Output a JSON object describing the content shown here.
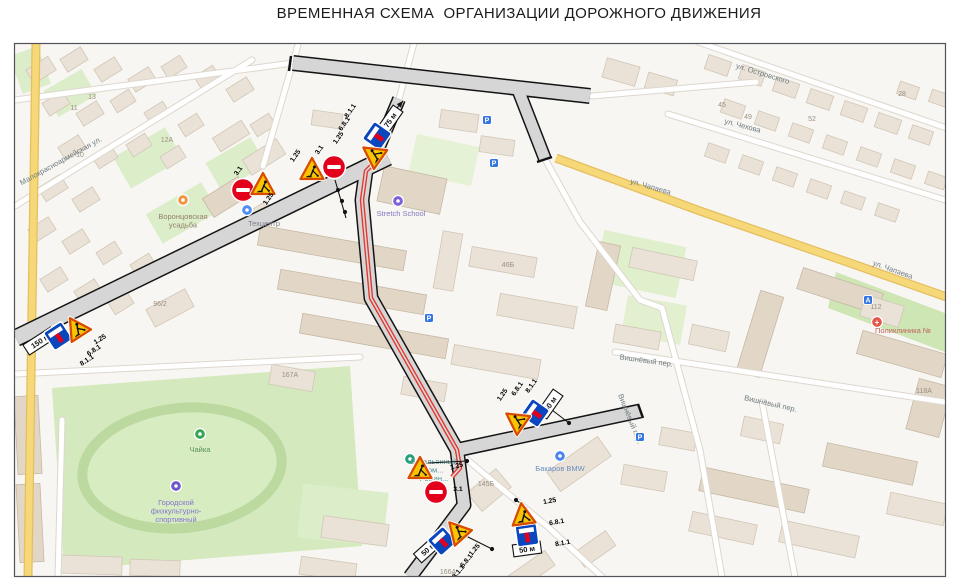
{
  "title": "ВРЕМЕННАЯ СХЕМА  ОРГАНИЗАЦИИ ДОРОЖНОГО ДВИЖЕНИЯ",
  "colors": {
    "map_background": "#f8f6f2",
    "work_road_fill": "#d6d6d6",
    "work_road_casing": "#141414",
    "detour_route_red": "#e5352c",
    "yellow_road": "#f7d878",
    "sign_yellow": "#f9c502",
    "sign_border_red": "#d84b00",
    "sign_blue": "#0a46be",
    "sign_red": "#e2001a",
    "green_area": "#d5e9bf"
  },
  "map": {
    "street_labels": [
      {
        "text": "ул. Островского",
        "x": 762,
        "y": 76,
        "rot": 17
      },
      {
        "text": "ул. Чехова",
        "x": 742,
        "y": 128,
        "rot": 15
      },
      {
        "text": "ул. Чапаева",
        "x": 650,
        "y": 189,
        "rot": 16
      },
      {
        "text": "ул. Чапаева",
        "x": 892,
        "y": 272,
        "rot": 20
      },
      {
        "text": "Вишнёвый пер.",
        "x": 646,
        "y": 363,
        "rot": 8
      },
      {
        "text": "Вишнёвый пер.",
        "x": 770,
        "y": 406,
        "rot": 13
      },
      {
        "text": "Вишнёвый пер.",
        "x": 628,
        "y": 420,
        "rot": 68
      },
      {
        "text": "Малокрасноармейская ул.",
        "x": 62,
        "y": 163,
        "rot": -29
      }
    ],
    "poi_labels": [
      {
        "lines": [
          "Воронцовская",
          "усадьба"
        ],
        "x": 183,
        "y": 219,
        "color": "#94806f",
        "icon_color": "#ef9744",
        "icon_glyph": "",
        "icon_x": 183,
        "icon_y": 200
      },
      {
        "lines": [
          "Техцентр"
        ],
        "x": 264,
        "y": 226,
        "color": "#7d828c",
        "icon_color": "#4f8df5",
        "icon_glyph": "",
        "icon_x": 247,
        "icon_y": 210
      },
      {
        "lines": [
          "Stretch School"
        ],
        "x": 401,
        "y": 216,
        "color": "#8577c0",
        "icon_color": "#7d5fd9",
        "icon_glyph": "",
        "icon_x": 398,
        "icon_y": 201
      },
      {
        "lines": [
          "Чайка"
        ],
        "x": 200,
        "y": 452,
        "color": "#57925d",
        "icon_color": "#3aa455",
        "icon_glyph": "",
        "icon_x": 200,
        "icon_y": 434
      },
      {
        "lines": [
          "Городской",
          "физкультурно-",
          "спортивный"
        ],
        "x": 176,
        "y": 505,
        "color": "#8374cf",
        "icon_color": "#6f58c9",
        "icon_glyph": "",
        "icon_x": 176,
        "icon_y": 486
      },
      {
        "lines": [
          "Бакаров BMW"
        ],
        "x": 560,
        "y": 471,
        "color": "#6b8fc0",
        "icon_color": "#4a86f0",
        "icon_glyph": "",
        "icon_x": 560,
        "icon_y": 456
      },
      {
        "lines": [
          "Поликлиника №"
        ],
        "x": 903,
        "y": 333,
        "color": "#c0625a",
        "icon_color": "#e4574b",
        "icon_glyph": "+",
        "icon_x": 877,
        "icon_y": 322
      },
      {
        "lines": [
          "Батальонный",
          "ком...",
          "Роман..."
        ],
        "x": 434,
        "y": 464,
        "color": "#4b9191",
        "icon_color": "#27a17b",
        "icon_glyph": "",
        "icon_x": 410,
        "icon_y": 459
      }
    ],
    "building_numbers": [
      {
        "text": "11",
        "x": 74,
        "y": 110
      },
      {
        "text": "13",
        "x": 92,
        "y": 99
      },
      {
        "text": "10",
        "x": 80,
        "y": 157
      },
      {
        "text": "12А",
        "x": 167,
        "y": 142
      },
      {
        "text": "96/2",
        "x": 160,
        "y": 306
      },
      {
        "text": "46Б",
        "x": 508,
        "y": 267
      },
      {
        "text": "167А",
        "x": 290,
        "y": 377
      },
      {
        "text": "145Б",
        "x": 486,
        "y": 486
      },
      {
        "text": "112",
        "x": 876,
        "y": 309
      },
      {
        "text": "118А",
        "x": 924,
        "y": 393
      },
      {
        "text": "45",
        "x": 722,
        "y": 107
      },
      {
        "text": "49",
        "x": 748,
        "y": 119
      },
      {
        "text": "52",
        "x": 812,
        "y": 121
      },
      {
        "text": "28",
        "x": 902,
        "y": 96
      },
      {
        "text": "166А",
        "x": 448,
        "y": 574
      }
    ],
    "transport_icons": [
      {
        "glyph": "P",
        "x": 487,
        "y": 120
      },
      {
        "glyph": "P",
        "x": 494,
        "y": 163
      },
      {
        "glyph": "P",
        "x": 429,
        "y": 318
      },
      {
        "glyph": "P",
        "x": 640,
        "y": 437
      },
      {
        "glyph": "A",
        "x": 868,
        "y": 300
      }
    ],
    "signs": [
      {
        "type": "plate_8_1_1",
        "text": "75 м",
        "x": 390,
        "y": 120,
        "rot": -55
      },
      {
        "type": "dead_end_6_8_1",
        "x": 377,
        "y": 136,
        "rot": -55
      },
      {
        "type": "roadworks_1_25",
        "x": 374,
        "y": 155,
        "rot": -55
      },
      {
        "type": "roadworks_1_25",
        "x": 312,
        "y": 171,
        "rot": 0
      },
      {
        "type": "no_entry_3_1",
        "x": 334,
        "y": 167,
        "rot": 0
      },
      {
        "type": "no_entry_3_1",
        "x": 243,
        "y": 190,
        "rot": 0
      },
      {
        "type": "roadworks_1_25",
        "x": 263,
        "y": 186,
        "rot": 0
      },
      {
        "type": "plate_8_1_1",
        "text": "150 м",
        "x": 40,
        "y": 341,
        "rot": -33
      },
      {
        "type": "dead_end_6_8_1",
        "x": 58,
        "y": 336,
        "rot": -33
      },
      {
        "type": "roadworks_1_25",
        "x": 77,
        "y": 329,
        "rot": -33
      },
      {
        "type": "plate_8_1_1",
        "text": "50 м",
        "x": 550,
        "y": 404,
        "rot": -55
      },
      {
        "type": "dead_end_6_8_1",
        "x": 535,
        "y": 413,
        "rot": -55
      },
      {
        "type": "roadworks_1_25",
        "x": 517,
        "y": 421,
        "rot": -55
      },
      {
        "type": "roadworks_1_25",
        "x": 420,
        "y": 470,
        "rot": 0
      },
      {
        "type": "no_entry_3_1",
        "x": 436,
        "y": 492,
        "rot": 0
      },
      {
        "type": "plate_8_1_1",
        "text": "50 м",
        "x": 527,
        "y": 549,
        "rot": -8
      },
      {
        "type": "dead_end_6_8_1",
        "x": 527,
        "y": 535,
        "rot": -8
      },
      {
        "type": "roadworks_1_25",
        "x": 523,
        "y": 516,
        "rot": -8
      },
      {
        "type": "plate_8_1_1",
        "text": "50 м",
        "x": 428,
        "y": 549,
        "rot": -42
      },
      {
        "type": "dead_end_6_8_1",
        "x": 442,
        "y": 541,
        "rot": -42
      },
      {
        "type": "roadworks_1_25",
        "x": 458,
        "y": 532,
        "rot": -42
      }
    ],
    "sign_labels": [
      {
        "text": "8.1.1",
        "x": 352,
        "y": 112,
        "rot": -55
      },
      {
        "text": "6.8.1",
        "x": 346,
        "y": 125,
        "rot": -55
      },
      {
        "text": "1.25",
        "x": 340,
        "y": 139,
        "rot": -55
      },
      {
        "text": "1.25",
        "x": 297,
        "y": 157,
        "rot": -55
      },
      {
        "text": "3.1",
        "x": 321,
        "y": 151,
        "rot": -55
      },
      {
        "text": "3.1",
        "x": 240,
        "y": 172,
        "rot": -55
      },
      {
        "text": "1.25",
        "x": 270,
        "y": 200,
        "rot": -55
      },
      {
        "text": "1.25",
        "x": 101,
        "y": 341,
        "rot": -33
      },
      {
        "text": "6.8.1",
        "x": 95,
        "y": 352,
        "rot": -33
      },
      {
        "text": "8.1.1",
        "x": 88,
        "y": 362,
        "rot": -33
      },
      {
        "text": "1.25",
        "x": 504,
        "y": 396,
        "rot": -55
      },
      {
        "text": "6.8.1",
        "x": 519,
        "y": 390,
        "rot": -55
      },
      {
        "text": "8.1.1",
        "x": 533,
        "y": 387,
        "rot": -55
      },
      {
        "text": "1.25",
        "x": 457,
        "y": 468,
        "rot": -15
      },
      {
        "text": "3.1",
        "x": 458,
        "y": 491,
        "rot": 0
      },
      {
        "text": "1.25",
        "x": 550,
        "y": 503,
        "rot": -10
      },
      {
        "text": "6.8.1",
        "x": 557,
        "y": 524,
        "rot": -10
      },
      {
        "text": "8.1.1",
        "x": 563,
        "y": 545,
        "rot": -10
      },
      {
        "text": "1.25",
        "x": 476,
        "y": 551,
        "rot": -50
      },
      {
        "text": "6.8.1",
        "x": 468,
        "y": 562,
        "rot": -50
      },
      {
        "text": "8.1.1",
        "x": 460,
        "y": 573,
        "rot": -50
      }
    ],
    "leaders": [
      {
        "pts": [
          [
            391,
            115
          ],
          [
            403,
            101
          ]
        ],
        "dots": [],
        "arrow": true
      },
      {
        "pts": [
          [
            335,
            180
          ],
          [
            346,
            218
          ]
        ],
        "dots": [
          [
            338,
            190
          ],
          [
            342,
            201
          ],
          [
            345,
            212
          ]
        ],
        "arrow": false
      },
      {
        "pts": [
          [
            552,
            410
          ],
          [
            569,
            423
          ]
        ],
        "dots": [
          [
            569,
            423
          ]
        ],
        "arrow": false
      },
      {
        "pts": [
          [
            428,
            463
          ],
          [
            467,
            461
          ]
        ],
        "dots": [
          [
            467,
            461
          ]
        ],
        "arrow": false
      },
      {
        "pts": [
          [
            527,
            508
          ],
          [
            516,
            500
          ]
        ],
        "dots": [
          [
            516,
            500
          ]
        ],
        "arrow": false
      },
      {
        "pts": [
          [
            466,
            536
          ],
          [
            492,
            549
          ]
        ],
        "dots": [
          [
            492,
            549
          ]
        ],
        "arrow": false
      }
    ]
  }
}
